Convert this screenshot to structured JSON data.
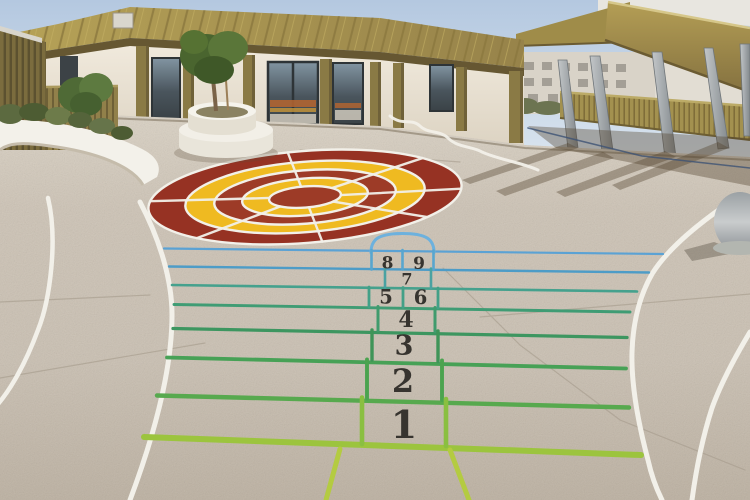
{
  "scene": {
    "description": "Sunlit school playground courtyard with painted target, hopscotch court and curved white running lines",
    "setting": "outdoor schoolyard, low modern building with olive metal roof and right-side canopy"
  },
  "hopscotch": {
    "numbers": {
      "n1": "1",
      "n2": "2",
      "n3": "3",
      "n4": "4",
      "n5": "5",
      "n6": "6",
      "n7": "7",
      "n8": "8",
      "n9": "9"
    },
    "line_colors": {
      "row_top_blue": "#5ba2d4",
      "row_blue2": "#4d9cc7",
      "row_teal": "#45a18d",
      "row_teal_green": "#3f9c74",
      "row_green1": "#3d9660",
      "row_green2": "#47a156",
      "row_green3": "#57a94e",
      "row_yellow_green": "#9cc43e",
      "start_lane": "#b4cb41",
      "arch_blue": "#6db1dd"
    }
  },
  "target": {
    "ring_colors": [
      "#963223",
      "#efba21",
      "#9d3b27",
      "#efba21",
      "#9d3b27"
    ],
    "separator_color": "#f2f0e9"
  },
  "palette": {
    "sky": "#b6cae1",
    "roof_metal": "#a8954e",
    "fascia_dark": "#665732",
    "wall_beige": "#e9e2d4",
    "pilaster_olive": "#8a7a45",
    "ground_concrete": "#ccc2b4",
    "marking_white": "#f2f0e9",
    "canopy_gold": "#a3904c",
    "column_gray": "#9aa0a4"
  }
}
